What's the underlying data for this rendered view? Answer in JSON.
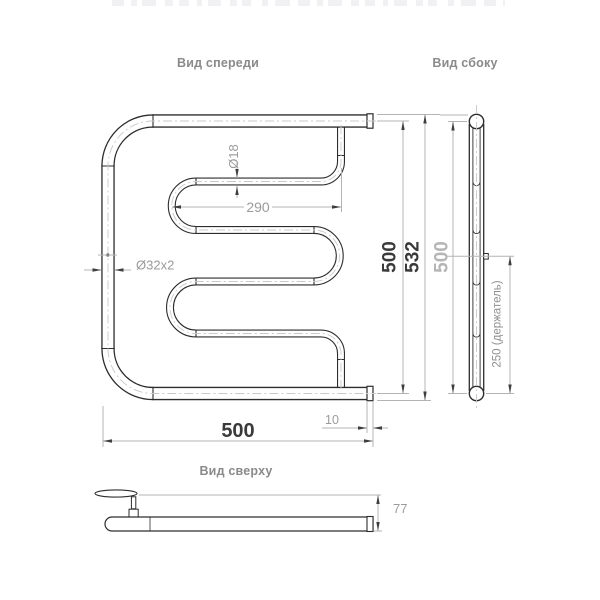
{
  "views": {
    "front": {
      "label": "Вид спереди",
      "dims": {
        "pipe_diameter_small": "Ø18",
        "serpentine_width": "290",
        "pipe_diameter_main": "Ø32x2",
        "overall_width": "500",
        "end_offset": "10",
        "height_centers": "500",
        "height_overall": "532"
      }
    },
    "side": {
      "label": "Вид сбоку",
      "dims": {
        "height_centers": "500",
        "holder_offset": "250 (держатель)"
      }
    },
    "top": {
      "label": "Вид сверху",
      "dims": {
        "depth_from_wall": "77"
      }
    }
  },
  "colors": {
    "background": "#ffffff",
    "outline": "#2d2d2d",
    "dimension_line": "#b4b4b4",
    "arrow": "#3f3f3f",
    "dimension_text": "#9b9b9b",
    "dimension_text_dark": "#3a3a3a",
    "dimension_text_light": "#b5b5b5",
    "centerline": "#c9c9c9",
    "label_text": "#8a8a8a"
  }
}
